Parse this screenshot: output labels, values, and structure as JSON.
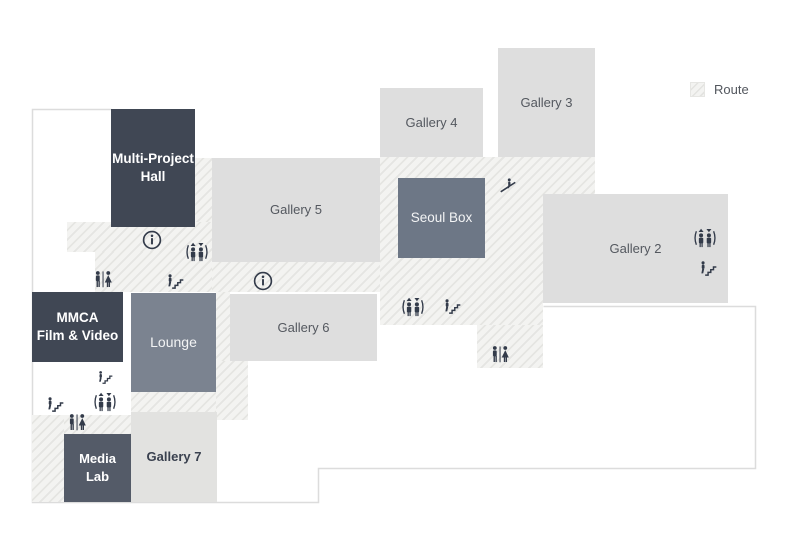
{
  "legend": {
    "route_label": "Route",
    "route_swatch": "diagonal-hatch-pattern"
  },
  "rooms": {
    "multi_project_hall": {
      "label": "Multi-Project\nHall"
    },
    "gallery_5": {
      "label": "Gallery 5"
    },
    "gallery_4": {
      "label": "Gallery 4"
    },
    "gallery_3": {
      "label": "Gallery 3"
    },
    "seoul_box": {
      "label": "Seoul Box"
    },
    "gallery_2": {
      "label": "Gallery 2"
    },
    "mmca_film_video": {
      "label": "MMCA\nFilm & Video"
    },
    "lounge": {
      "label": "Lounge"
    },
    "gallery_6": {
      "label": "Gallery 6"
    },
    "gallery_7": {
      "label": "Gallery 7"
    },
    "media_lab": {
      "label": "Media\nLab"
    }
  },
  "icons": {
    "info-icon": "circled i information point",
    "elevator-icon": "two people with up and down arrows",
    "stairs-icon": "person climbing stairs",
    "escalator-icon": "person on escalator",
    "restroom-icon": "man and woman divided figures"
  },
  "colors": {
    "dark_room": "#404754",
    "seoul_box_room": "#6d7786",
    "lounge_room": "#7b8390",
    "light_room": "#dedede",
    "icon": "#333b4a",
    "hatch_background": "#f3f3f1",
    "hatch_stripe": "#e5e5e2",
    "floor_outline": "#dcdcdc"
  }
}
